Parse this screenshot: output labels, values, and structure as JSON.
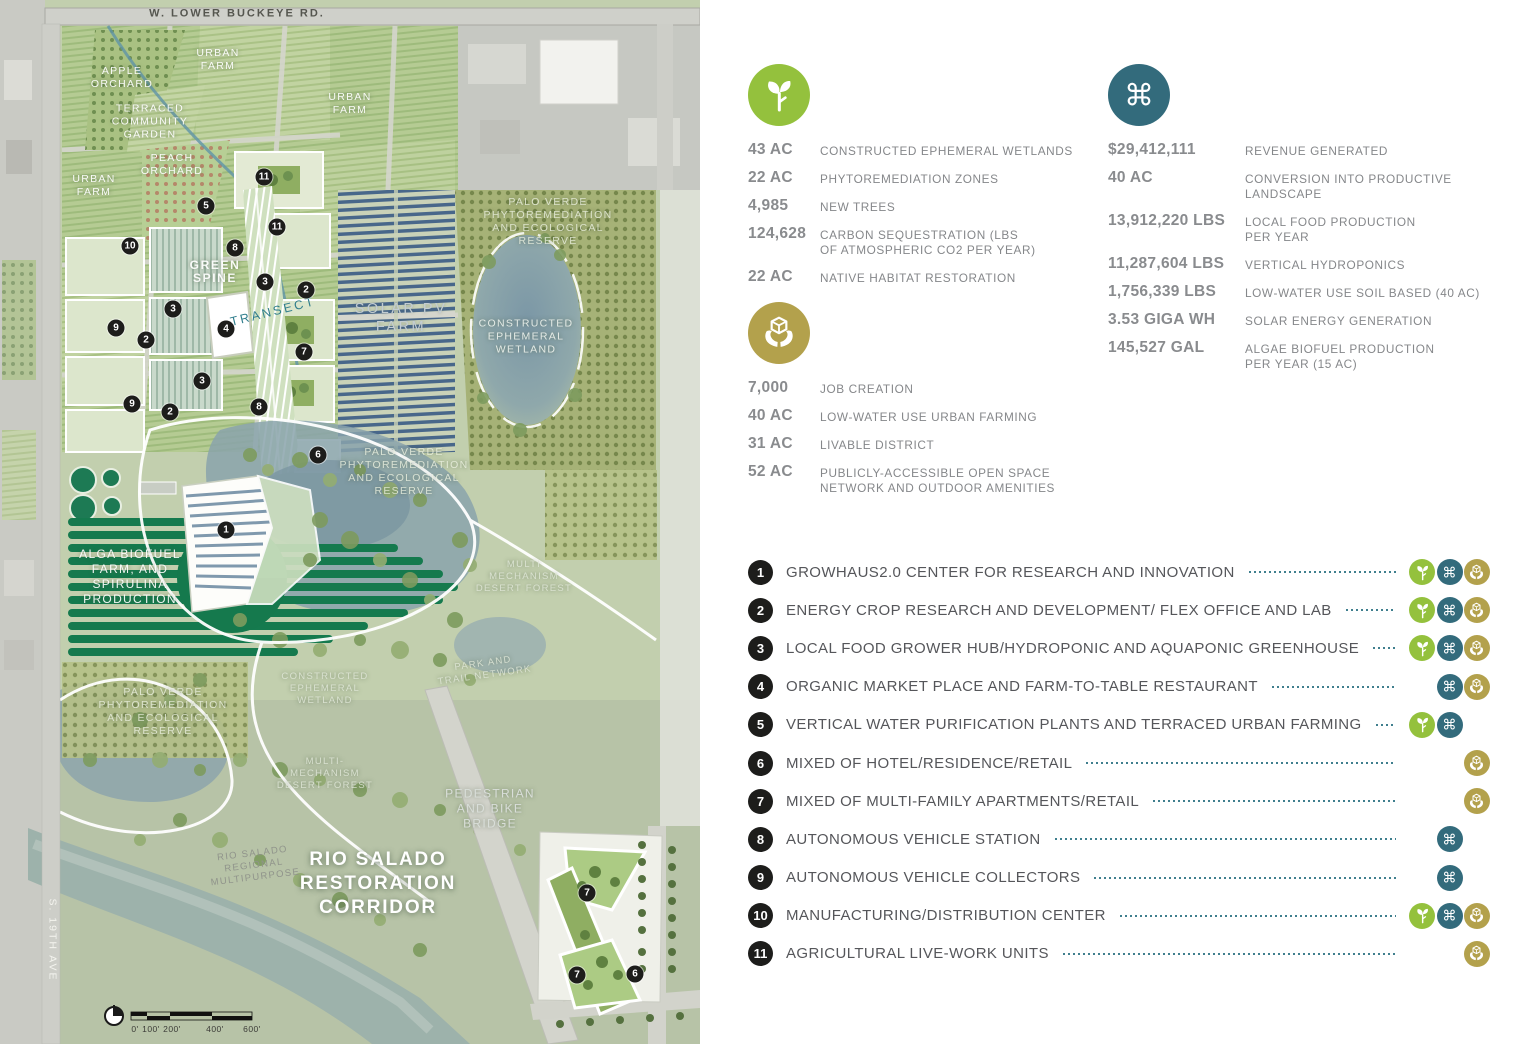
{
  "colors": {
    "plant_green": "#94c13d",
    "production_teal": "#336b7c",
    "community_gold": "#b3a14c",
    "leader_teal": "#3f7f8e",
    "value_gray": "#898b8e",
    "label_gray": "#85878a",
    "marker_black": "#1d1d1b"
  },
  "stats": {
    "environment": {
      "icon": "plant",
      "rows": [
        {
          "value": "43 AC",
          "label": "CONSTRUCTED EPHEMERAL WETLANDS"
        },
        {
          "value": "22 AC",
          "label": "PHYTOREMEDIATION ZONES"
        },
        {
          "value": "4,985",
          "label": "NEW TREES"
        },
        {
          "value": "124,628",
          "label": "CARBON SEQUESTRATION (LBS\nOF ATMOSPHERIC CO2 PER YEAR)"
        },
        {
          "value": "22 AC",
          "label": "NATIVE HABITAT RESTORATION"
        }
      ]
    },
    "production": {
      "icon": "command",
      "rows": [
        {
          "value": "$29,412,111",
          "label": "REVENUE GENERATED"
        },
        {
          "value": "40 AC",
          "label": "CONVERSION INTO PRODUCTIVE\nLANDSCAPE"
        },
        {
          "value": "13,912,220 LBS",
          "label": "LOCAL FOOD PRODUCTION\nPER YEAR"
        },
        {
          "value": "11,287,604 LBS",
          "label": "VERTICAL HYDROPONICS"
        },
        {
          "value": "1,756,339 LBS",
          "label": "LOW-WATER USE SOIL BASED (40 AC)"
        },
        {
          "value": "3.53 GIGA WH",
          "label": "SOLAR ENERGY GENERATION"
        },
        {
          "value": "145,527 GAL",
          "label": "ALGAE BIOFUEL PRODUCTION\nPER YEAR (15 AC)"
        }
      ]
    },
    "community": {
      "icon": "hands",
      "rows": [
        {
          "value": "7,000",
          "label": "JOB CREATION"
        },
        {
          "value": "40 AC",
          "label": "LOW-WATER USE URBAN FARMING"
        },
        {
          "value": "31 AC",
          "label": "LIVABLE DISTRICT"
        },
        {
          "value": "52 AC",
          "label": "PUBLICLY-ACCESSIBLE OPEN SPACE\nNETWORK AND OUTDOOR AMENITIES"
        }
      ]
    }
  },
  "legend": {
    "items": [
      {
        "num": "1",
        "label": "GROWHAUS2.0 CENTER FOR RESEARCH AND INNOVATION",
        "icons": [
          "plant",
          "production",
          "community"
        ]
      },
      {
        "num": "2",
        "label": "ENERGY CROP RESEARCH AND DEVELOPMENT/ FLEX OFFICE AND LAB",
        "icons": [
          "plant",
          "production",
          "community"
        ]
      },
      {
        "num": "3",
        "label": "LOCAL FOOD GROWER HUB/HYDROPONIC AND AQUAPONIC GREENHOUSE",
        "icons": [
          "plant",
          "production",
          "community"
        ]
      },
      {
        "num": "4",
        "label": "ORGANIC MARKET PLACE AND FARM-TO-TABLE RESTAURANT",
        "icons": [
          "production",
          "community"
        ]
      },
      {
        "num": "5",
        "label": "VERTICAL WATER PURIFICATION PLANTS AND TERRACED URBAN FARMING",
        "icons": [
          "plant",
          "production"
        ]
      },
      {
        "num": "6",
        "label": "MIXED OF HOTEL/RESIDENCE/RETAIL",
        "icons": [
          "community"
        ]
      },
      {
        "num": "7",
        "label": "MIXED  OF MULTI-FAMILY APARTMENTS/RETAIL",
        "icons": [
          "community"
        ]
      },
      {
        "num": "8",
        "label": "AUTONOMOUS VEHICLE STATION",
        "icons": [
          "production"
        ]
      },
      {
        "num": "9",
        "label": "AUTONOMOUS VEHICLE COLLECTORS",
        "icons": [
          "production"
        ]
      },
      {
        "num": "10",
        "label": "MANUFACTURING/DISTRIBUTION CENTER",
        "icons": [
          "plant",
          "production",
          "community"
        ]
      },
      {
        "num": "11",
        "label": "AGRICULTURAL LIVE-WORK UNITS",
        "icons": [
          "community"
        ]
      }
    ]
  },
  "map": {
    "labels": [
      {
        "text": "W. LOWER BUCKEYE RD.",
        "x": 237,
        "y": 14,
        "cls": "road"
      },
      {
        "text": "APPLE\nORCHARD",
        "x": 122,
        "y": 78,
        "cls": "wh"
      },
      {
        "text": "URBAN\nFARM",
        "x": 218,
        "y": 60,
        "cls": "wh"
      },
      {
        "text": "URBAN\nFARM",
        "x": 350,
        "y": 104,
        "cls": "wh"
      },
      {
        "text": "TERRACED\nCOMMUNITY\nGARDEN",
        "x": 150,
        "y": 122,
        "cls": "wh"
      },
      {
        "text": "PEACH\nORCHARD",
        "x": 172,
        "y": 165,
        "cls": "wh"
      },
      {
        "text": "URBAN\nFARM",
        "x": 94,
        "y": 186,
        "cls": "wh"
      },
      {
        "text": "PALO VERDE\nPHYTOREMEDIATION\nAND ECOLOGICAL\nRESERVE",
        "x": 548,
        "y": 222,
        "cls": "palo"
      },
      {
        "text": "GREEN\nSPINE",
        "x": 215,
        "y": 272,
        "cls": "whb"
      },
      {
        "text": "TRANSECT",
        "x": 273,
        "y": 312,
        "cls": "transect",
        "rot": -14
      },
      {
        "text": "SOLAR PV\nFARM",
        "x": 401,
        "y": 318,
        "cls": "solar"
      },
      {
        "text": "CONSTRUCTED\nEPHEMERAL\nWETLAND",
        "x": 526,
        "y": 337,
        "cls": "wet"
      },
      {
        "text": "PALO VERDE\nPHYTOREMEDIATION\nAND ECOLOGICAL\nRESERVE",
        "x": 404,
        "y": 472,
        "cls": "palo"
      },
      {
        "text": "ALGA BIOFUEL\nFARM, AND\nSPIRULINA\nPRODUCTION",
        "x": 130,
        "y": 577,
        "cls": "wh2"
      },
      {
        "text": "MULTI\nMECHANISM\nDESERT FOREST",
        "x": 524,
        "y": 577,
        "cls": "gr"
      },
      {
        "text": "PARK AND\nTRAIL NETWORK",
        "x": 484,
        "y": 670,
        "cls": "gr",
        "rot": -8
      },
      {
        "text": "CONSTRUCTED\nEPHEMERAL\nWETLAND",
        "x": 325,
        "y": 689,
        "cls": "gr"
      },
      {
        "text": "PALO VERDE\nPHYTOREMEDIATION\nAND ECOLOGICAL\nRESERVE",
        "x": 163,
        "y": 712,
        "cls": "palo"
      },
      {
        "text": "MULTI-\nMECHANISM\nDESERT FOREST",
        "x": 325,
        "y": 774,
        "cls": "gr"
      },
      {
        "text": "PEDESTRIAN\nAND BIKE\nBRIDGE",
        "x": 490,
        "y": 809,
        "cls": "ped"
      },
      {
        "text": "RIO SALADO\nREGIONAL\nMULTIPURPOSE",
        "x": 254,
        "y": 866,
        "cls": "reg",
        "rot": -7
      },
      {
        "text": "RIO SALADO\nRESTORATION\nCORRIDOR",
        "x": 378,
        "y": 884,
        "cls": "title"
      },
      {
        "text": "S. 19TH AVE",
        "x": 52,
        "y": 940,
        "cls": "s19",
        "rot": 90
      }
    ],
    "markers": [
      {
        "n": "11",
        "x": 264,
        "y": 177
      },
      {
        "n": "5",
        "x": 206,
        "y": 206
      },
      {
        "n": "11",
        "x": 277,
        "y": 227
      },
      {
        "n": "10",
        "x": 130,
        "y": 246
      },
      {
        "n": "8",
        "x": 235,
        "y": 248
      },
      {
        "n": "3",
        "x": 265,
        "y": 282
      },
      {
        "n": "2",
        "x": 306,
        "y": 290
      },
      {
        "n": "3",
        "x": 173,
        "y": 309
      },
      {
        "n": "9",
        "x": 116,
        "y": 328
      },
      {
        "n": "4",
        "x": 226,
        "y": 329
      },
      {
        "n": "2",
        "x": 146,
        "y": 340
      },
      {
        "n": "7",
        "x": 304,
        "y": 352
      },
      {
        "n": "3",
        "x": 202,
        "y": 381
      },
      {
        "n": "9",
        "x": 132,
        "y": 404
      },
      {
        "n": "8",
        "x": 259,
        "y": 407
      },
      {
        "n": "2",
        "x": 170,
        "y": 412
      },
      {
        "n": "6",
        "x": 318,
        "y": 455
      },
      {
        "n": "1",
        "x": 226,
        "y": 530
      },
      {
        "n": "7",
        "x": 587,
        "y": 893
      },
      {
        "n": "7",
        "x": 577,
        "y": 975
      },
      {
        "n": "6",
        "x": 635,
        "y": 974
      }
    ],
    "scale": {
      "ticks": [
        {
          "t": "0'",
          "x": 135
        },
        {
          "t": "100'",
          "x": 151
        },
        {
          "t": "200'",
          "x": 172
        },
        {
          "t": "400'",
          "x": 215
        },
        {
          "t": "600'",
          "x": 252
        }
      ]
    }
  }
}
